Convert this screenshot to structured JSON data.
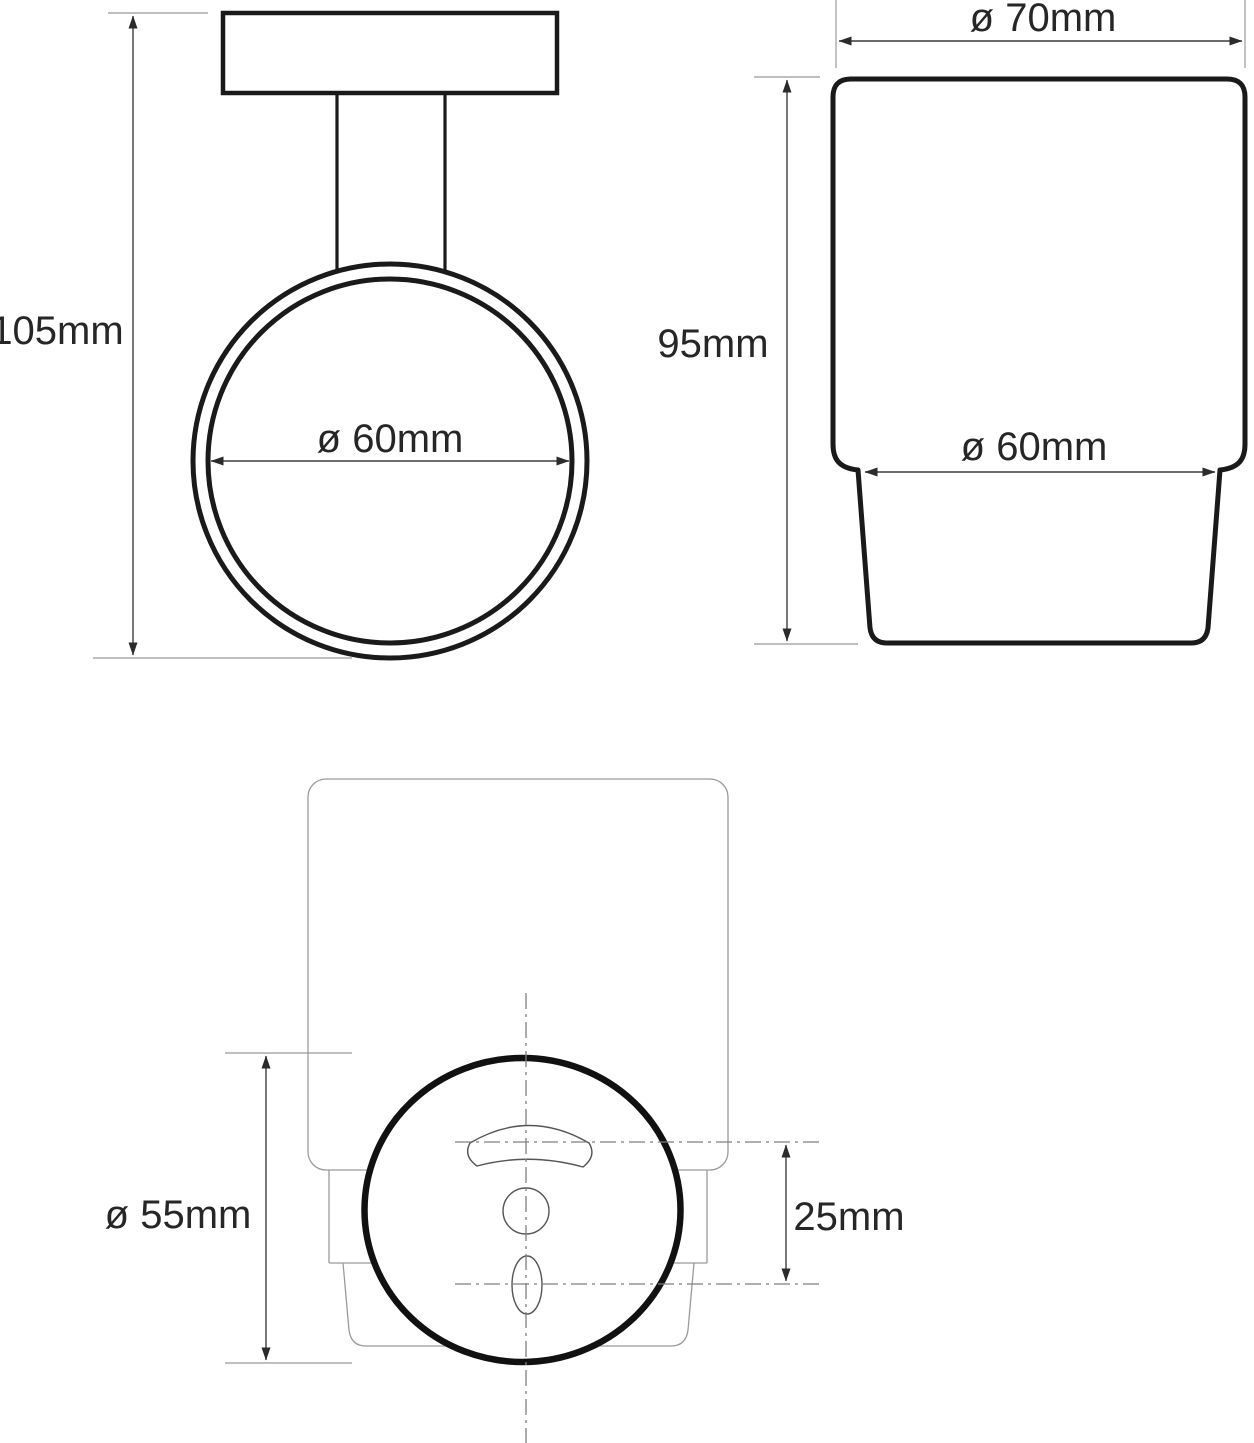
{
  "drawing": {
    "title": "Wall-mounted tumbler holder — dimensioned technical drawing",
    "views": {
      "front": {
        "name": "front view of wall-mounted holder ring",
        "height_label": "105mm",
        "ring_diameter_label": "ø 60mm"
      },
      "side": {
        "name": "side view of glass tumbler",
        "top_diameter_label": "ø 70mm",
        "height_label": "95mm",
        "body_diameter_label": "ø 60mm"
      },
      "back": {
        "name": "rear view with mounting plate",
        "plate_diameter_label": "ø 55mm",
        "hole_spacing_label": "25mm"
      }
    },
    "colors": {
      "outline": "#1a1a1a",
      "dimension_line": "#3c3c3c",
      "extension_line": "#999999",
      "hidden_line": "#9a9a9a",
      "centerline": "#7f7f7f",
      "hole_line": "#555555",
      "text": "#262626",
      "background": "#ffffff"
    }
  }
}
